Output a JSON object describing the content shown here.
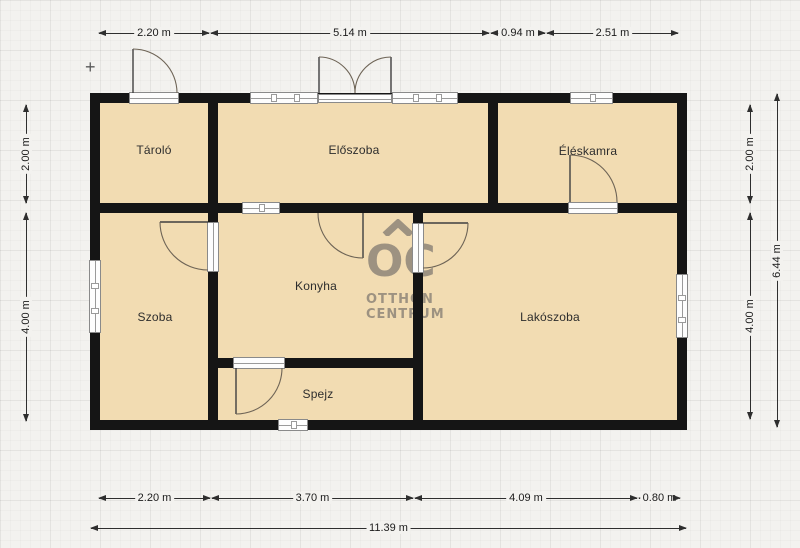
{
  "colors": {
    "room-fill": "#f2dcb2",
    "wall": "#151515",
    "watermark": "#9d9281",
    "bg": "#f3f2ef",
    "line": "#2e2e2e"
  },
  "rooms": {
    "tarolo": "Tároló",
    "eloszoba": "Előszoba",
    "eleskamra": "Éléskamra",
    "szoba": "Szoba",
    "konyha": "Konyha",
    "lakoszoba": "Lakószoba",
    "spejz": "Spejz"
  },
  "watermark": {
    "monogram": "OC",
    "line1": "OTTHON",
    "line2": "CENTRUM"
  },
  "dims": {
    "top": [
      "2.20 m",
      "5.14 m",
      "0.94 m",
      "2.51 m"
    ],
    "bottom": [
      "2.20 m",
      "3.70 m",
      "4.09 m",
      "0.80 m"
    ],
    "bottom_total": "11.39 m",
    "left": [
      "2.00 m",
      "4.00 m"
    ],
    "right": [
      "2.00 m",
      "4.00 m"
    ],
    "right_total": "6.44 m"
  },
  "markers": {
    "origin_cross": "+"
  }
}
